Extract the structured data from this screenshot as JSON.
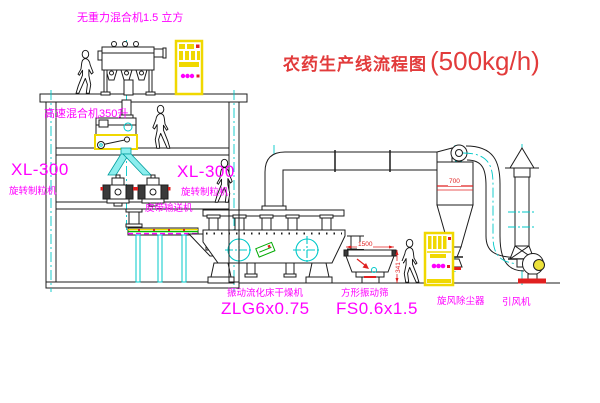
{
  "title": {
    "name": "农药生产线流程图",
    "capacity": "(500kg/h)"
  },
  "labels": {
    "gravity_free_mixer": "无重力混合机1.5 立方",
    "high_speed_mixer": "高速混合机350升",
    "granulator_left": {
      "model": "XL-300",
      "name": "旋转制粒机"
    },
    "granulator_mid": {
      "model": "XL-300",
      "name": "旋转制粒机"
    },
    "belt_conveyor": "皮带输送机",
    "fluid_bed_dryer": {
      "name": "振动流化床干燥机",
      "model": "ZLG6x0.75"
    },
    "square_sieve": {
      "name": "方形振动筛",
      "model": "FS0.6x1.5"
    },
    "cyclone": "旋风除尘器",
    "induced_draft_fan": "引风机"
  },
  "dimensions": {
    "sieve_length": "1500",
    "sieve_height": "341",
    "cyclone_tag": "700"
  },
  "colors": {
    "label_magenta": "#ff00ff",
    "title_red": "#e23b3b",
    "cad_yellow": "#f0d800",
    "cad_cyan": "#00c8c8",
    "cad_green": "#00aa00",
    "line_black": "#1c1c1c"
  }
}
